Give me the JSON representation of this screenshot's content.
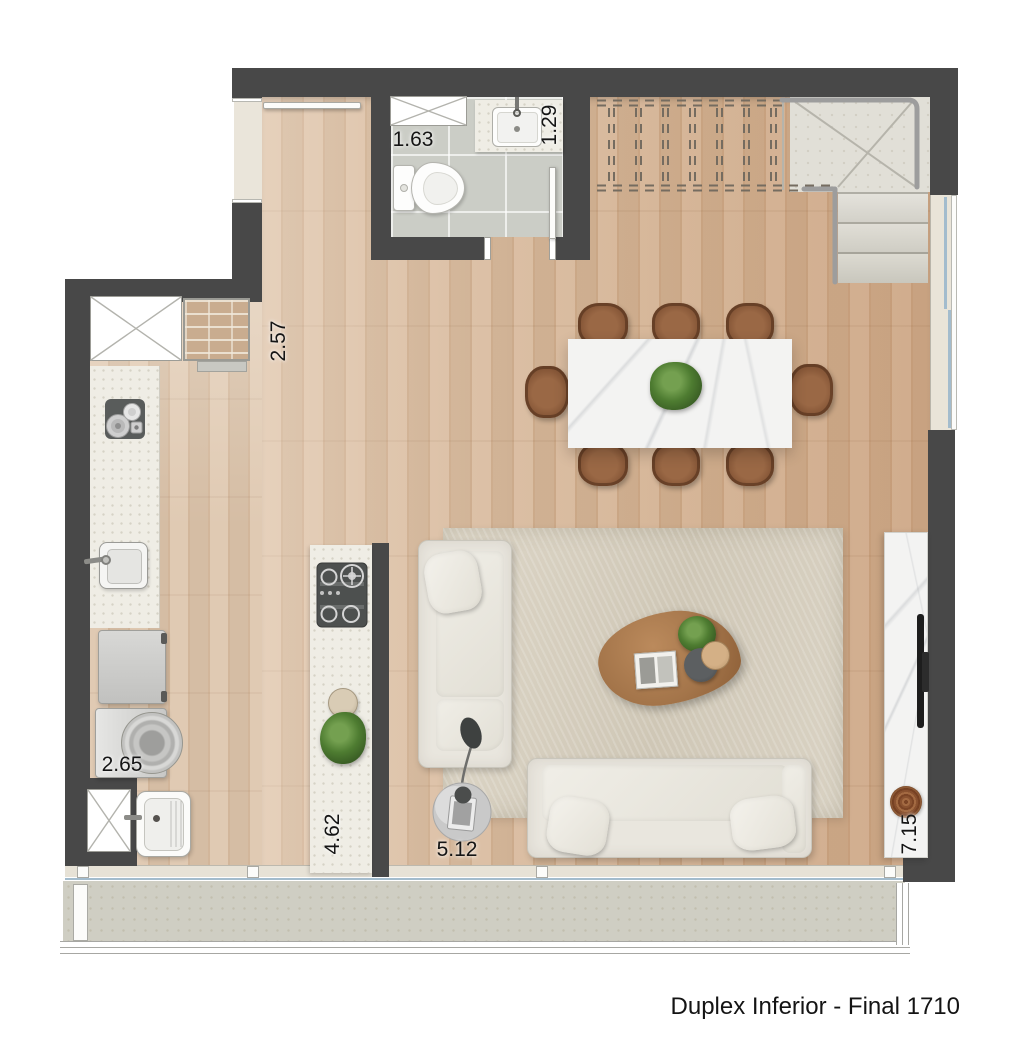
{
  "caption": "Duplex Inferior - Final 1710",
  "dimension_labels": {
    "bathroom": "1.63",
    "bathroom_sink": "1.29",
    "hall": "2.57",
    "laundry": "2.65",
    "kitchen_island": "4.62",
    "living": "5.12",
    "living_depth": "7.15"
  },
  "fixtures": [
    "ventilation-shaft",
    "toilet",
    "washbasin",
    "brick-column",
    "countertop-appliance",
    "kitchen-sink",
    "refrigerator",
    "washing-machine",
    "laundry-tub",
    "gas-cooktop",
    "kitchen-island",
    "dining-table",
    "dining-chair",
    "staircase",
    "handrail",
    "sofa",
    "floor-lamp",
    "coffee-table",
    "rug",
    "tv-panel",
    "decor-bowl",
    "sliding-window",
    "balcony",
    "balcony-railing",
    "entry-door"
  ],
  "colors": {
    "wall": "#484848",
    "wood_floor": "#d6b697",
    "wood_floor_light": "#dcc3a9",
    "tile": "#cbcdc6",
    "counter": "#efede5",
    "marble": "#f3f3f2",
    "chair_brown": "#8a5a3a",
    "coffee_table_wood": "#a4754a",
    "rug": "#d6cfc0",
    "concrete": "#cfcec3",
    "glass": "#a3bccd",
    "plant_green": "#4e7c31",
    "label_text": "#151515"
  }
}
